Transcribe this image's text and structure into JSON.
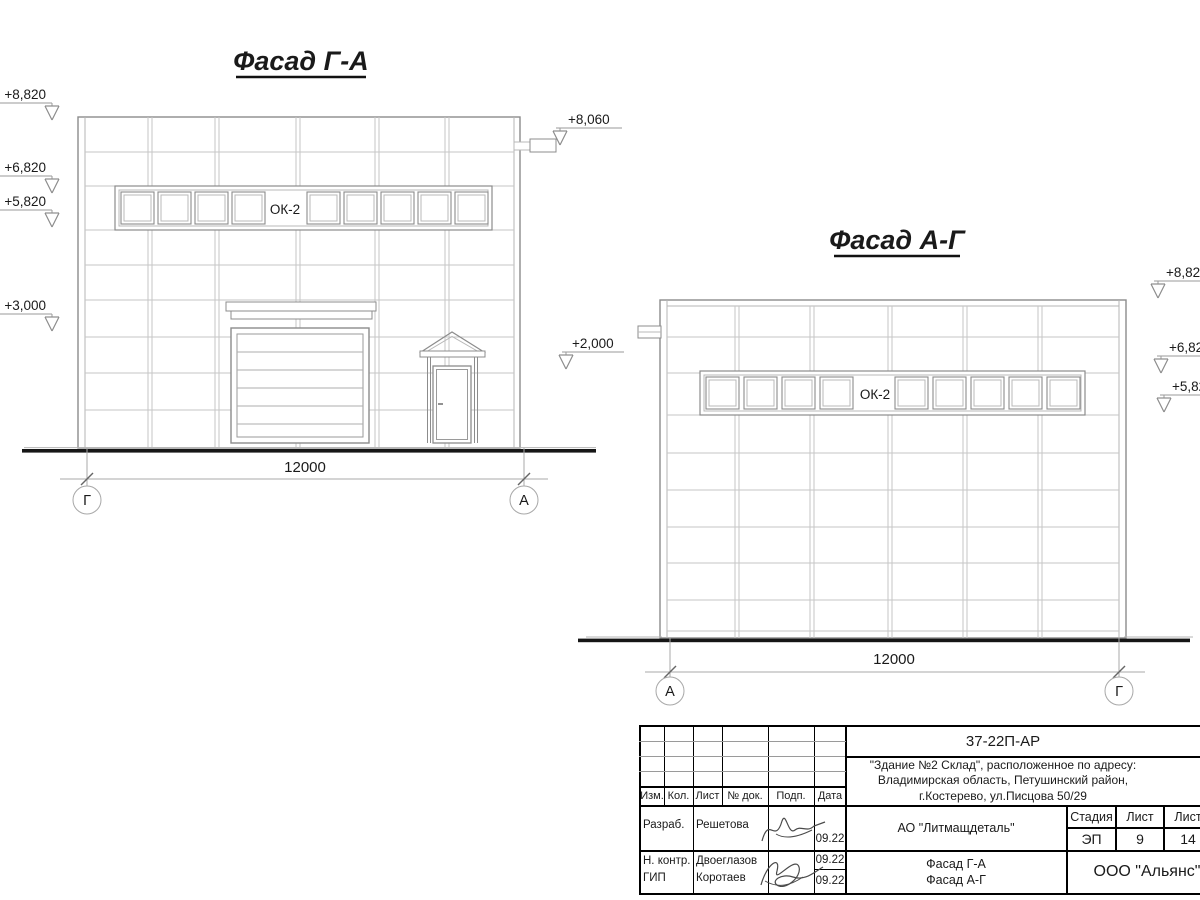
{
  "facade_ga": {
    "title": "Фасад Г-А",
    "window_label": "ОК-2",
    "dimension": "12000",
    "axis_left": "Г",
    "axis_right": "А",
    "elev_8820": "+8,820",
    "elev_6820": "+6,820",
    "elev_5820": "+5,820",
    "elev_3000": "+3,000",
    "elev_8060": "+8,060",
    "elev_2000": "+2,000"
  },
  "facade_ag": {
    "title": "Фасад А-Г",
    "window_label": "ОК-2",
    "dimension": "12000",
    "axis_left": "А",
    "axis_right": "Г",
    "elev_8820": "+8,820",
    "elev_6820": "+6,820",
    "elev_5820": "+5,820"
  },
  "titleblock": {
    "doc_number": "37-22П-АР",
    "project_line1": "\"Здание №2 Склад\", расположенное по адресу:",
    "project_line2": "Владимирская область, Петушинский район,",
    "project_line3": "г.Костерево, ул.Писцова 50/29",
    "col_izm": "Изм.",
    "col_kol": "Кол.",
    "col_list": "Лист",
    "col_doc": "№ док.",
    "col_podp": "Подп.",
    "col_data": "Дата",
    "row1_role": "Разраб.",
    "row1_name": "Решетова",
    "row1_date": "09.22",
    "row2_role": "Н. контр.",
    "row2_name": "Двоеглазов",
    "row2_date": "09.22",
    "row3_role": "ГИП",
    "row3_name": "Коротаев",
    "row3_date": "09.22",
    "client": "АО \"Литмащдеталь\"",
    "stage_label": "Стадия",
    "sheet_label": "Лист",
    "sheets_label": "Лист",
    "stage_value": "ЭП",
    "sheet_value": "9",
    "sheets_value": "14",
    "sheet_title_line1": "Фасад Г-А",
    "sheet_title_line2": "Фасад А-Г",
    "organization": "ООО \"Альянс\""
  }
}
